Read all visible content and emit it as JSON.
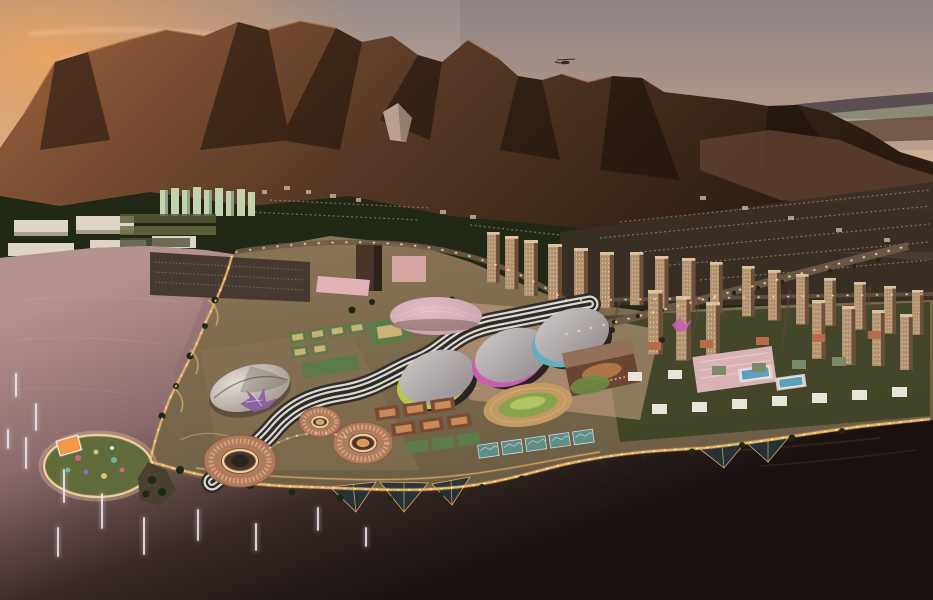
{
  "scene": {
    "description": "Aerial dusk rendering of a waterfront Olympic sports park beneath coastal mountains, venues illuminated, fountains in a lagoon, city towers behind",
    "time_of_day": "dusk",
    "elements": [
      "sunset-sky",
      "sun-glow",
      "helicopter",
      "mountain-range",
      "distant-ridge",
      "hillside-forest",
      "city-suburbs",
      "residential-towers",
      "lagoon",
      "fountain-jets",
      "live-site-island",
      "video-screen",
      "velodrome-dome",
      "purple-canopy",
      "white-dome-arena",
      "arena-hall-green",
      "arena-hall-magenta",
      "arena-hall-teal",
      "brown-arena",
      "aquatic-center",
      "swimming-pools",
      "tennis-courts",
      "training-courts",
      "athletics-track",
      "circular-stadium-1",
      "circular-stadium-2",
      "circular-stadium-3",
      "striped-walkway",
      "tree-lined-boulevard",
      "media-buildings",
      "waterfront-promenade",
      "garden-lattice",
      "ocean"
    ]
  },
  "palette": {
    "sky_top": "#958a8c",
    "sky_mid": "#c9ad95",
    "sky_horizon": "#eccfa4",
    "sun_glow": "#f2a55c",
    "cloud": "#f0d9b4",
    "far_ridge": "#564a4e",
    "far_valley": "#a3a386",
    "far_ridge2": "#6b5244",
    "foothill": "#5d4030",
    "mtn_lit": "#9a5f3d",
    "mtn_mid": "#553825",
    "mtn_dark": "#2a1c12",
    "mtn_shadow": "#1a100a",
    "ridge_lit": "#b57246",
    "rock": "#c6ae9c",
    "forest": "#222816",
    "heli": "#332c24",
    "warehouse": "#ded5c6",
    "green_tower": "#c3d2ae",
    "suburb": "#cbb69d",
    "city_band": "#3b2f26",
    "tower_face": "#b09272",
    "tower_side": "#6b4f39",
    "tower_window": "#f3c98d",
    "dark_tower": "#473428",
    "pink_bldg": "#d8a8a4",
    "pink_mall": "#e3b2b8",
    "road": "#6e5a48",
    "side_road": "#57483c",
    "water_lagoon": "#b5928f",
    "water_mid": "#8a6a6c",
    "water_dark": "#3a2a26",
    "water_ocean": "#181110",
    "glint": "#6b4026",
    "shore_gold": "#e9b468",
    "light_warm": "#ffd9a2",
    "fountain": "#eee8f2",
    "lattice": "#26333a",
    "park_tan": "#8c7656",
    "park_tan_dark": "#6b5d44",
    "plaza": "#caa588",
    "lawn": "#3c4226",
    "tree": "#1f2715",
    "path_light": "#caa98a",
    "stripe_dark": "#2c2b29",
    "stripe_light": "#ddd8cf",
    "roof_light": "#ccc6c6",
    "roof_dark": "#9a9294",
    "arena_base": "#2b2320",
    "end_green": "#b8c84e",
    "end_magenta": "#c75fae",
    "end_teal": "#62aec2",
    "dome_pink": "#e4bec6",
    "dome_pink_dark": "#c69fab",
    "velo_light": "#e2dcd4",
    "velo_dark": "#a29890",
    "tent_purple": "#8a5fa0",
    "future_brown": "#6a4534",
    "future_roof": "#92705a",
    "future_glow": "#f0a860",
    "aquatic_pink": "#d9b2b6",
    "pool": "#5e9fc0",
    "stadium_terra": "#b07a5e",
    "stadium_rib": "#d9a87c",
    "stadium_rim": "#f2cf9c",
    "bowl": "#4a332a",
    "track": "#c39a63",
    "infield": "#8aa34e",
    "court_green": "#5d7a4a",
    "court_tan": "#c9b273",
    "court_clay": "#c98a5a",
    "court_clay_dark": "#7a4a34",
    "court_teal": "#5f8d87",
    "screen_orange": "#f09a4a",
    "media_white": "#e8e4da",
    "media_red": "#b86a4a",
    "media_green": "#7a8a6a"
  }
}
